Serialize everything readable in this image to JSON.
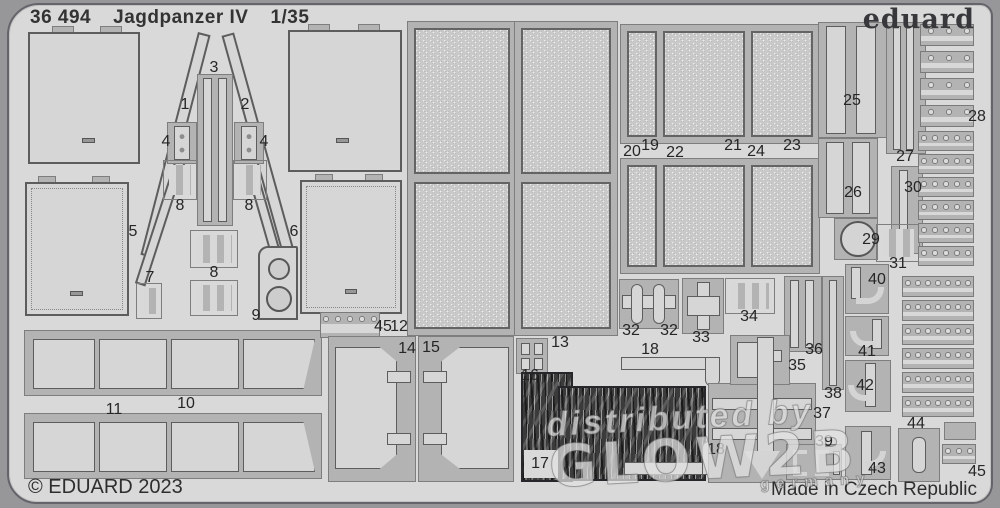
{
  "header": {
    "catalog_number": "36 494",
    "title": "Jagdpanzer IV",
    "scale": "1/35"
  },
  "brand": {
    "logo_text": "eduard"
  },
  "footer": {
    "copyright": "© EDUARD 2023",
    "made_in": "Made in Czech Republic"
  },
  "watermark": {
    "line1": "distributed by",
    "line2": "GLOW2B",
    "line3": "germany"
  },
  "colors": {
    "background": "#97979a",
    "sheet": "#d9d9d9",
    "fret_web": "#b3b3b3",
    "part_fill": "#d6d6d6",
    "part_outline": "#5d5d5d",
    "dark_camo_part": "#3b3b3b",
    "label_text": "#262626",
    "watermark_text": "rgba(250,250,250,0.62)"
  },
  "part_labels": [
    {
      "n": "1",
      "x": 185,
      "y": 105
    },
    {
      "n": "2",
      "x": 245,
      "y": 105
    },
    {
      "n": "3",
      "x": 214,
      "y": 68
    },
    {
      "n": "4",
      "x": 166,
      "y": 142
    },
    {
      "n": "4",
      "x": 264,
      "y": 142
    },
    {
      "n": "5",
      "x": 133,
      "y": 232
    },
    {
      "n": "6",
      "x": 294,
      "y": 232
    },
    {
      "n": "7",
      "x": 150,
      "y": 278
    },
    {
      "n": "8",
      "x": 180,
      "y": 206
    },
    {
      "n": "8",
      "x": 249,
      "y": 206
    },
    {
      "n": "8",
      "x": 214,
      "y": 273
    },
    {
      "n": "9",
      "x": 256,
      "y": 316
    },
    {
      "n": "10",
      "x": 186,
      "y": 404
    },
    {
      "n": "11",
      "x": 114,
      "y": 410
    },
    {
      "n": "12",
      "x": 399,
      "y": 327
    },
    {
      "n": "13",
      "x": 560,
      "y": 343
    },
    {
      "n": "14",
      "x": 407,
      "y": 349
    },
    {
      "n": "15",
      "x": 431,
      "y": 348
    },
    {
      "n": "16",
      "x": 530,
      "y": 376
    },
    {
      "n": "17",
      "x": 540,
      "y": 464
    },
    {
      "n": "18",
      "x": 650,
      "y": 350
    },
    {
      "n": "18",
      "x": 716,
      "y": 450
    },
    {
      "n": "19",
      "x": 650,
      "y": 146
    },
    {
      "n": "20",
      "x": 632,
      "y": 152
    },
    {
      "n": "21",
      "x": 733,
      "y": 146
    },
    {
      "n": "22",
      "x": 675,
      "y": 153
    },
    {
      "n": "23",
      "x": 792,
      "y": 146
    },
    {
      "n": "24",
      "x": 756,
      "y": 152
    },
    {
      "n": "25",
      "x": 852,
      "y": 101
    },
    {
      "n": "26",
      "x": 853,
      "y": 193
    },
    {
      "n": "27",
      "x": 905,
      "y": 157
    },
    {
      "n": "28",
      "x": 977,
      "y": 117
    },
    {
      "n": "29",
      "x": 871,
      "y": 240
    },
    {
      "n": "30",
      "x": 913,
      "y": 188
    },
    {
      "n": "31",
      "x": 898,
      "y": 264
    },
    {
      "n": "32",
      "x": 631,
      "y": 331
    },
    {
      "n": "32",
      "x": 669,
      "y": 331
    },
    {
      "n": "33",
      "x": 701,
      "y": 338
    },
    {
      "n": "34",
      "x": 749,
      "y": 317
    },
    {
      "n": "35",
      "x": 797,
      "y": 366
    },
    {
      "n": "36",
      "x": 814,
      "y": 350
    },
    {
      "n": "37",
      "x": 822,
      "y": 414
    },
    {
      "n": "38",
      "x": 833,
      "y": 394
    },
    {
      "n": "39",
      "x": 824,
      "y": 442
    },
    {
      "n": "40",
      "x": 877,
      "y": 280
    },
    {
      "n": "41",
      "x": 867,
      "y": 352
    },
    {
      "n": "42",
      "x": 865,
      "y": 386
    },
    {
      "n": "43",
      "x": 877,
      "y": 469
    },
    {
      "n": "44",
      "x": 916,
      "y": 424
    },
    {
      "n": "45",
      "x": 383,
      "y": 327
    },
    {
      "n": "45",
      "x": 977,
      "y": 472
    }
  ]
}
